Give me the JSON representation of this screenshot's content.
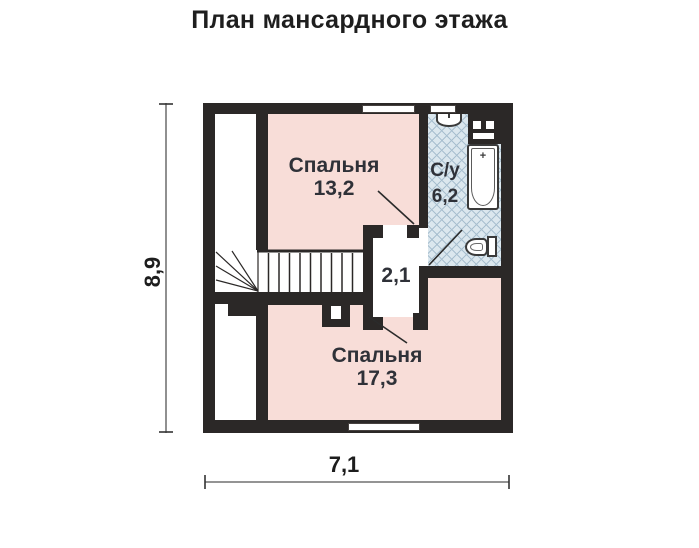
{
  "title": "План мансардного этажа",
  "plan": {
    "rooms": {
      "bedroom_top": {
        "name": "Спальня",
        "area": "13,2"
      },
      "bathroom": {
        "name": "С/у",
        "area": "6,2"
      },
      "hall": {
        "area": "2,1"
      },
      "bedroom_bottom": {
        "name": "Спальня",
        "area": "17,3"
      }
    },
    "dimensions": {
      "height_m": "8,9",
      "width_m": "7,1"
    },
    "stairs": {
      "tread_count": 9
    },
    "colors": {
      "wall": "#2b2827",
      "bedroom_fill": "#f8ddd8",
      "bathroom_fill": "#dbe7ee",
      "hatch_line": "#a8bfcf",
      "label_text": "#2f3138",
      "dimension_text": "#1d1d1d"
    }
  }
}
